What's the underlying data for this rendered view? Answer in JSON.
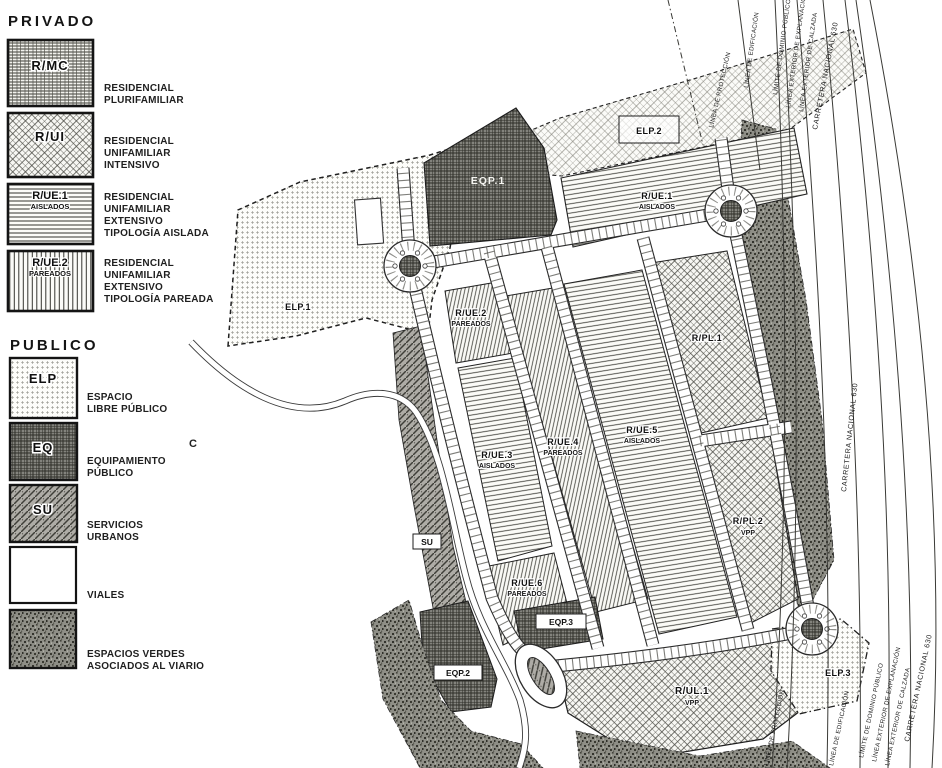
{
  "legend": {
    "privado": {
      "title": "PRIVADO",
      "items": [
        {
          "code": "R/MC",
          "sub": "",
          "lines": [
            "RESIDENCIAL",
            "PLURIFAMILIAR"
          ]
        },
        {
          "code": "R/UI",
          "sub": "",
          "lines": [
            "RESIDENCIAL",
            "UNIFAMILIAR",
            "INTENSIVO"
          ]
        },
        {
          "code": "R/UE.1",
          "sub": "AISLADOS",
          "lines": [
            "RESIDENCIAL",
            "UNIFAMILIAR",
            "EXTENSIVO",
            "TIPOLOGÍA AISLADA"
          ]
        },
        {
          "code": "R/UE.2",
          "sub": "PAREADOS",
          "lines": [
            "RESIDENCIAL",
            "UNIFAMILIAR",
            "EXTENSIVO",
            "TIPOLOGÍA PAREADA"
          ]
        }
      ]
    },
    "publico": {
      "title": "PUBLICO",
      "items": [
        {
          "code": "ELP",
          "lines": [
            "ESPACIO",
            "LIBRE PÚBLICO"
          ]
        },
        {
          "code": "EQ",
          "lines": [
            "EQUIPAMIENTO",
            "PÚBLICO"
          ]
        },
        {
          "code": "SU",
          "lines": [
            "SERVICIOS",
            "URBANOS"
          ]
        },
        {
          "code": "",
          "lines": [
            "VIALES"
          ]
        },
        {
          "code": "",
          "lines": [
            "ESPACIOS VERDES",
            "ASOCIADOS AL VIARIO"
          ]
        }
      ]
    }
  },
  "map": {
    "zones": {
      "elp1": {
        "code": "ELP.1"
      },
      "eqp1": {
        "code": "EQP.1"
      },
      "elp2": {
        "code": "ELP.2"
      },
      "rue1": {
        "code": "R/UE.1",
        "sub": "AISLADOS"
      },
      "rue2": {
        "code": "R/UE.2",
        "sub": "PAREADOS"
      },
      "rue3": {
        "code": "R/UE.3",
        "sub": "AISLADOS"
      },
      "rue4": {
        "code": "R/UE.4",
        "sub": "PAREADOS"
      },
      "rue5": {
        "code": "R/UE.5",
        "sub": "AISLADOS"
      },
      "rue6": {
        "code": "R/UE.6",
        "sub": "PAREADOS"
      },
      "rpl1": {
        "code": "R/PL.1"
      },
      "rpl2": {
        "code": "R/PL.2",
        "sub": "VPP"
      },
      "su": {
        "code": "SU"
      },
      "eqp2": {
        "code": "EQP.2"
      },
      "eqp3": {
        "code": "EQP.3"
      },
      "rul1": {
        "code": "R/UL.1",
        "sub": "VPP"
      },
      "elp3": {
        "code": "ELP.3"
      },
      "c_mark": "C"
    },
    "boundary_labels": [
      "LÍNEA DE PROTECCIÓN",
      "LÍNEA DE EDIFICACIÓN",
      "LÍMITE DE DOMINIO PÚBLICO",
      "LÍNEA EXTERIOR DE EXPLANACIÓN",
      "LÍNEA EXTERIOR DE CALZADA"
    ],
    "highway_label": "CARRETERA NACIONAL 630"
  },
  "colors": {
    "ink": "#1a1a1a",
    "dark_zone": "#83837f",
    "speckle": "#8e8e88",
    "paper": "#ffffff"
  }
}
